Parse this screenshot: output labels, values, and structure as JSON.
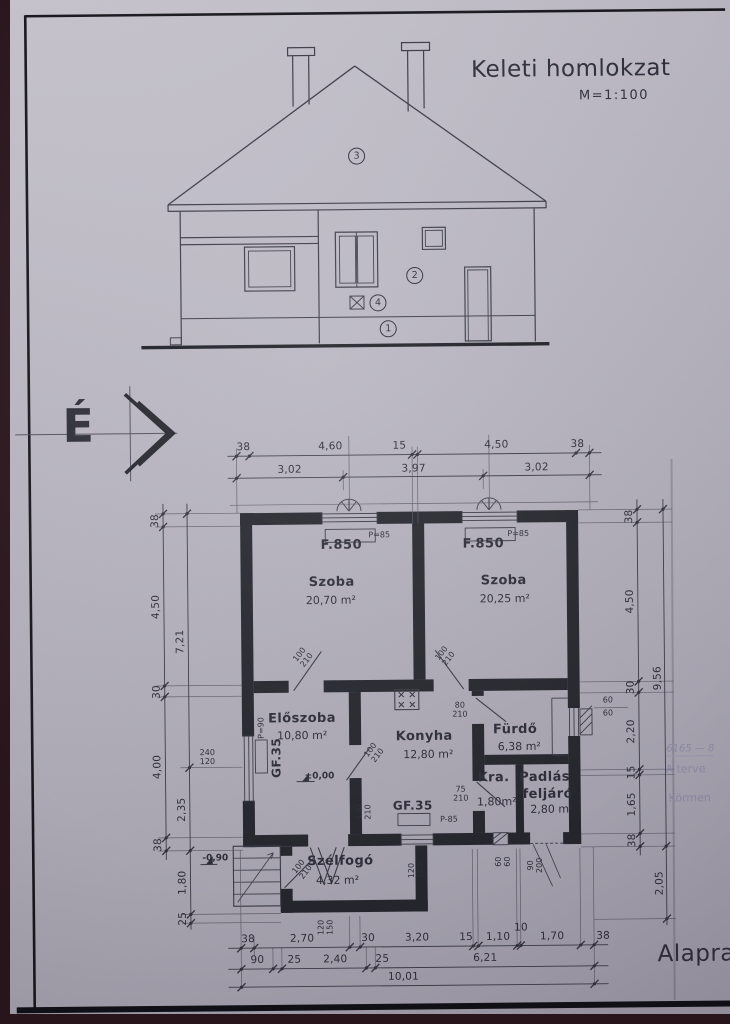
{
  "header": {
    "title": "Keleti homlokzat",
    "scale": "M=1:100"
  },
  "footer": {
    "plan_title": "Alapra"
  },
  "north": {
    "label": "É"
  },
  "elevation": {
    "marker1": "1",
    "marker2": "2",
    "marker3": "3",
    "marker4": "4"
  },
  "rooms": {
    "szoba1": {
      "name": "Szoba",
      "area": "20,70 m²"
    },
    "szoba2": {
      "name": "Szoba",
      "area": "20,25 m²"
    },
    "eloszoba": {
      "name": "Előszoba",
      "area": "10,80 m²"
    },
    "konyha": {
      "name": "Konyha",
      "area": "12,80 m²"
    },
    "furdo": {
      "name": "Fürdő",
      "area": "6,38 m²"
    },
    "kamra": {
      "name": "Kra.",
      "area": "1,80m²"
    },
    "padlas": {
      "name_line1": "Padlás",
      "name_line2": "feljáró",
      "area": "2,80 m²"
    },
    "szelfogo": {
      "name": "Szélfogó",
      "area": "4,32 m²"
    }
  },
  "tags": {
    "f850": "F.850",
    "p85": "P=85",
    "p85b": "P-85",
    "p90": "P=90",
    "gf35": "GF.35"
  },
  "levels": {
    "zero": "±0,00",
    "minus": "-0,90"
  },
  "dims": {
    "top_row1": [
      "38",
      "4,60",
      "15",
      "4,50",
      "38"
    ],
    "top_row2": [
      "3,02",
      "3,97",
      "3,02"
    ],
    "bottom_row1": [
      "38",
      "2,70",
      "30",
      "3,20",
      "15",
      "1,10",
      "10",
      "1,70",
      "38"
    ],
    "bottom_row2": [
      "90",
      "25",
      "2,40",
      "25",
      "6,21"
    ],
    "bottom_total": "10,01",
    "left_outer": [
      "38",
      "4,50",
      "30",
      "4,00",
      "38"
    ],
    "left_inner": [
      "7,21",
      "2,35",
      "1,80",
      "25"
    ],
    "right_outer": [
      "38",
      "4,50",
      "30",
      "2,20",
      "15",
      "1,65",
      "38"
    ],
    "right_inner": [
      "9,56",
      "2,05"
    ]
  },
  "openings": {
    "n100": "100",
    "n210": "210",
    "n80": "80",
    "n75": "75",
    "n130": "130",
    "n90": "90",
    "n200": "200",
    "n240": "240",
    "n120": "120",
    "n60": "60",
    "n150": "150"
  },
  "notes": {
    "line1": "6165 — 8",
    "line2": "A terve",
    "line3": "Körmen"
  }
}
